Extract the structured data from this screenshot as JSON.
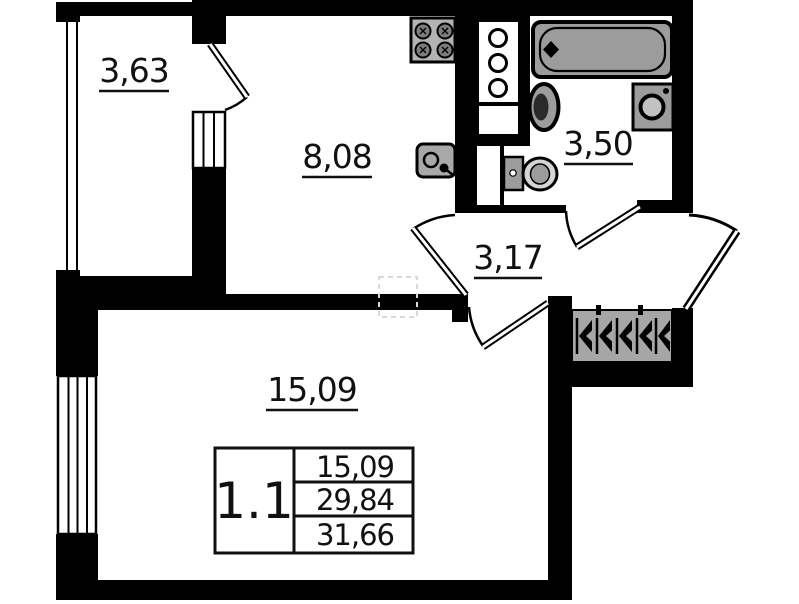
{
  "plan": {
    "title": "apartment-floor-plan",
    "rooms": [
      {
        "id": "balcony",
        "area": "3,63"
      },
      {
        "id": "kitchen",
        "area": "8,08"
      },
      {
        "id": "bathroom",
        "area": "3,50"
      },
      {
        "id": "hallway",
        "area": "3,17"
      },
      {
        "id": "living-room",
        "area": "15,09"
      }
    ],
    "legend": {
      "unit": "1.1",
      "rows": [
        "15,09",
        "29,84",
        "31,66"
      ]
    },
    "fixtures": [
      "stove",
      "kitchen-sink",
      "vent-shaft",
      "bathtub",
      "wash-basin",
      "washing-machine",
      "toilet",
      "wardrobe-hangers"
    ],
    "colors": {
      "wall": "#000000",
      "fixture_fill": "#9c9c9c",
      "fixture_light": "#d5d5d5",
      "stove_fill": "#b3b3b3",
      "wardrobe_fill": "#a6a6a6",
      "bg": "#ffffff"
    }
  }
}
